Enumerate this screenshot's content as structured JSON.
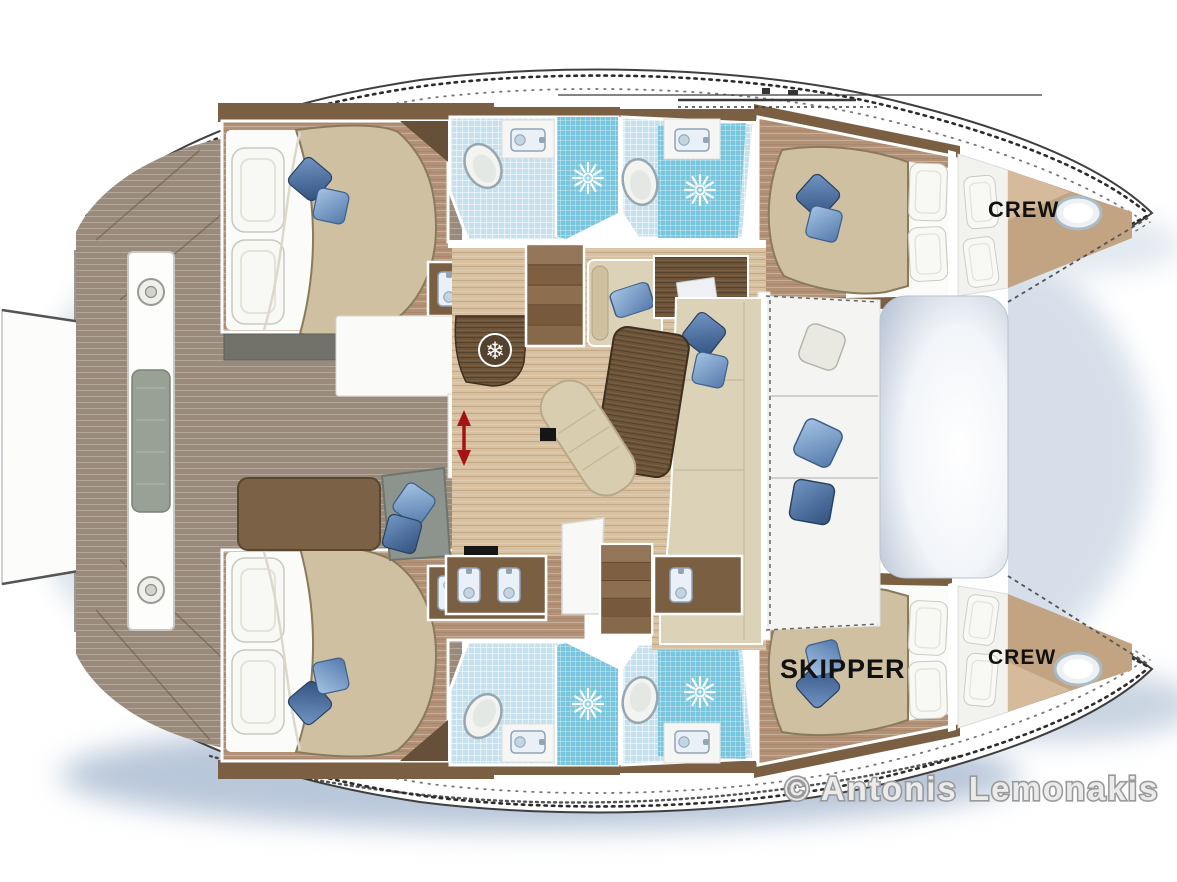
{
  "scene": {
    "description": "Top-view floor plan of a sailing catamaran with four double cabins, four bathrooms, salon, cockpit deck, bow trampoline and two bow crew berths"
  },
  "labels": {
    "crew_port": "CREW",
    "crew_starboard": "CREW",
    "skipper": "SKIPPER",
    "copyright": "© Antonis Lemonakis"
  },
  "icons": {
    "freezer_snowflake": {
      "name": "snowflake-icon",
      "glyph": "❄"
    },
    "shower_drain": {
      "name": "shower-sunburst-icon",
      "count": 4
    },
    "toilet": {
      "name": "toilet-icon",
      "count": 6
    },
    "sink_basin": {
      "name": "sink-icon",
      "count": 9
    },
    "sliding_door_arrow": {
      "name": "red-double-arrow-icon",
      "color": "#a31515"
    },
    "deck_hatch": {
      "name": "hatch-icon",
      "count": 2
    }
  },
  "colors": {
    "hull_white": "#ffffff",
    "shadow_blue": "#c3cfdf",
    "teak_deck": "#9a8a7b",
    "cabin_floor": "#b29176",
    "salon_floor": "#d8c1a0",
    "wall_wood": "#7a5f43",
    "furniture_wood": "#6d5438",
    "mattress_beige": "#cfc0a2",
    "sofa_beige": "#dcd2b8",
    "pillow_blue": "#6389bc",
    "pillow_blue_dark": "#41679c",
    "bath_tile_blue": "#c5e1ed",
    "shower_blue": "#78c6de",
    "bow_deck_tan": "#c2a382",
    "arrow_red": "#a31515",
    "label_black": "#111111",
    "copyright_gray": "#9a9a9a"
  }
}
